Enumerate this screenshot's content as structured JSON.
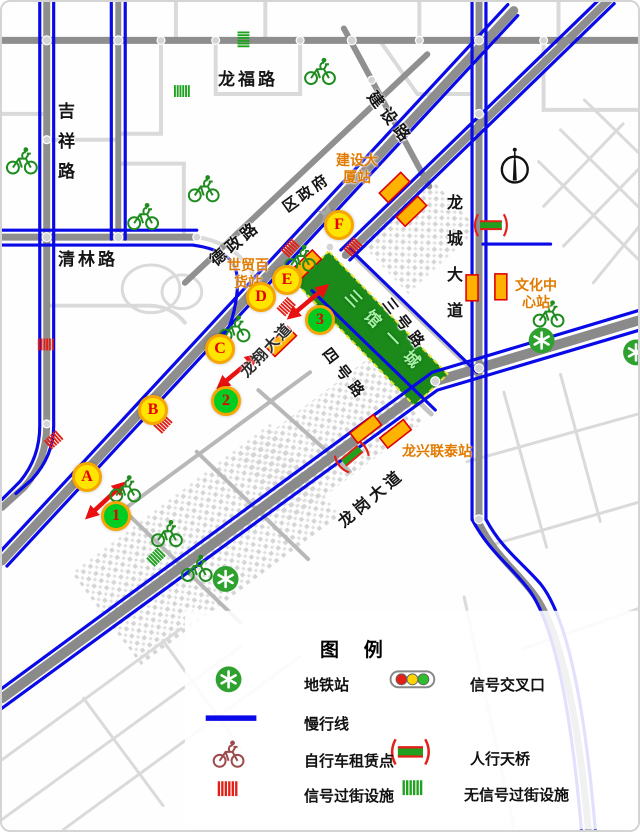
{
  "map": {
    "roads": {
      "jixiang": "吉祥路",
      "longfu": "龙福路",
      "qinglin": "清林路",
      "jianshe": "建设路",
      "dezheng": "德政路",
      "quzhengfu": "区政府",
      "longcheng": "龙城大道",
      "longxiang": "龙翔大道",
      "sanhao": "三号路",
      "sihao": "四号路",
      "longgang": "龙岗大道"
    },
    "park": {
      "name": "三馆一城"
    },
    "stations": {
      "jianshedasha": {
        "line1": "建设大",
        "line2": "厦站"
      },
      "shimaobaihuo": {
        "line1": "世贸百",
        "line2": "货站"
      },
      "wenhuazhongxin": {
        "line1": "文化中",
        "line2": "心站"
      },
      "longxinglentai": {
        "name": "龙兴联泰站"
      }
    },
    "markers": {
      "letters": [
        "A",
        "B",
        "C",
        "D",
        "E",
        "F"
      ],
      "numbers": [
        "1",
        "2",
        "3"
      ]
    }
  },
  "legend": {
    "title": "图 例",
    "rows": [
      {
        "icon": "metro-station-icon",
        "label": "地铁站"
      },
      {
        "icon": "traffic-light-icon",
        "label": "信号交叉口"
      },
      {
        "icon": "slow-line-icon",
        "label": "慢行线"
      },
      {
        "icon": "bike-rental-icon",
        "label": "自行车租赁点"
      },
      {
        "icon": "pedestrian-bridge-icon",
        "label": "人行天桥"
      },
      {
        "icon": "signal-crossing-icon",
        "label": "信号过街设施"
      },
      {
        "icon": "no-signal-crossing-icon",
        "label": "无信号过街设施"
      }
    ]
  },
  "colors": {
    "slow_line_blue": "#0A0AE8",
    "road_gray": "#8E8E8E",
    "minor_road_gray": "#DADADA",
    "station_orange": "#E07B00",
    "station_fill": "#FFB300",
    "marker_red": "#E60000",
    "marker_yellow": "#FFE400",
    "marker_green": "#00CC22",
    "ring_orange": "#F7A500",
    "park_green": "#1B8A1B",
    "park_text_green": "#A9F2A9",
    "bike_green": "#1E8C1E",
    "metro_green": "#2FA12F",
    "crossing_red": "#E32017",
    "crossing_green": "#1FA11F"
  }
}
